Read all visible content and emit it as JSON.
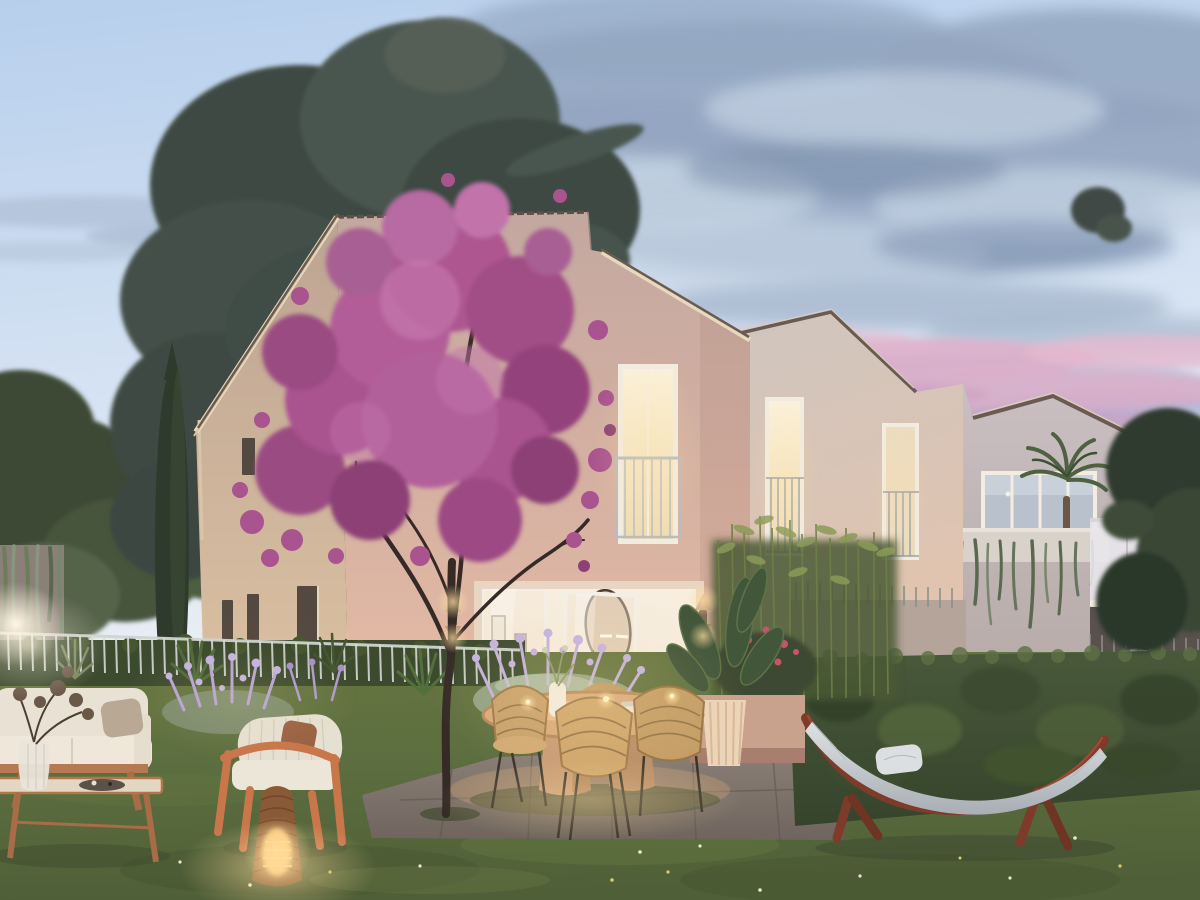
{
  "scene": {
    "description": "Twilight architectural rendering of a modern cream gabled residence with terraced garden: magenta blossom tree before the warm-lit facade, open living room onto a dining patio with wicker chairs, outdoor lounge sofa and glowing wicker lantern on the lawn, lavender beds behind a white picket fence, tall clipped hedge with a wooden arc-stand hammock, neighbouring white houses with balconies and a palm, large dark cedar behind, pink-streaked dusk clouds.",
    "time_of_day": "dusk",
    "elements": [
      {
        "name": "sky",
        "description": "pale blue dusk sky, grey-blue cloud bank upper right, pink sunset streaks mid right"
      },
      {
        "name": "cedar-tree",
        "description": "large dark cedar behind the main house"
      },
      {
        "name": "cypress-tree",
        "description": "tall slim cypress at left"
      },
      {
        "name": "main-house",
        "description": "warm beige gabled house, lit Juliet-balcony window, open glazed living room"
      },
      {
        "name": "second-house",
        "description": "set-back gabled facade with two lit tall windows"
      },
      {
        "name": "third-house",
        "description": "white house with glazed band, palm terrace, ivy parapet, frosted balcony"
      },
      {
        "name": "blossom-tree",
        "description": "magenta flowering tree in front of facade"
      },
      {
        "name": "garden-fence",
        "description": "white vertical-bar fence over low hedge"
      },
      {
        "name": "lounge-set",
        "description": "white outdoor sofa, wooden coffee table with glass vase, wooden rope armchair"
      },
      {
        "name": "wicker-lantern",
        "description": "glowing rattan floor lantern on lawn"
      },
      {
        "name": "dining-set",
        "description": "oval wooden pedestal table, four rattan chairs, candles"
      },
      {
        "name": "hammock",
        "description": "white hammock on curved mahogany arc stand"
      },
      {
        "name": "hedge",
        "description": "tall clipped hedge along right boundary"
      },
      {
        "name": "lawn",
        "description": "green lawn with warm lamplight pools"
      },
      {
        "name": "lavender",
        "description": "lavender and silver-foliage beds"
      },
      {
        "name": "bamboo",
        "description": "airy bamboo screen in front of second facade"
      }
    ]
  },
  "palette": {
    "sky_top": "#b7cfec",
    "sky_mid": "#d6e3f3",
    "sky_low": "#eef0f4",
    "cloud_gray": "#93a6c0",
    "cloud_gray_light": "#c6d3e4",
    "cloud_gray_dark": "#7e92ae",
    "cloud_pink": "#dfadc8",
    "cloud_pink_deep": "#cd9ec2",
    "cedar_dark": "#3c4843",
    "cedar_mid": "#4a5650",
    "leaf_dark": "#3d4a34",
    "leaf_mid": "#4e5e40",
    "cypress_green": "#2e3a2b",
    "facade_top": "#c3a8a0",
    "facade_bottom": "#eec2a8",
    "gable_top": "#bda493",
    "gable_bottom": "#e5c8a6",
    "facade_b_top": "#cfc5be",
    "facade_b_bottom": "#e2c4ae",
    "facade_c": "#c9bfc2",
    "roof_fascia": "#e7d9bd",
    "roof_tile": "#6b5a50",
    "window_warm": "#f8ecd2",
    "frame_white": "#f2ece1",
    "railing_gray": "#aab0b4",
    "interior_cream": "#f4ead8",
    "hedge_dark": "#35442b",
    "hedge_mid": "#49593a",
    "hedge_light": "#5d7045",
    "grass_dark": "#4f5f37",
    "grass_mid": "#5d6f40",
    "grass_light": "#8a9a58",
    "patio_gray": "#8d8178",
    "patio_dark": "#6f655e",
    "hammock_wood": "#7e3b2a",
    "hammock_fabric": "#ccd1d4",
    "table_wood": "#d9ab7c",
    "wicker": "#c9a26c",
    "sofa_white": "#e9e2d4",
    "armchair_wood": "#c8764a",
    "blossom_bright": "#c173aa",
    "blossom_mid": "#a9538f",
    "blossom_deep": "#8c4076",
    "trunk_dark": "#352a26",
    "lavender_light": "#c4b2e0",
    "lavender_mid": "#a78fc8",
    "glow_warm": "#ffdf9f",
    "lamp_white": "#fff6e2"
  }
}
